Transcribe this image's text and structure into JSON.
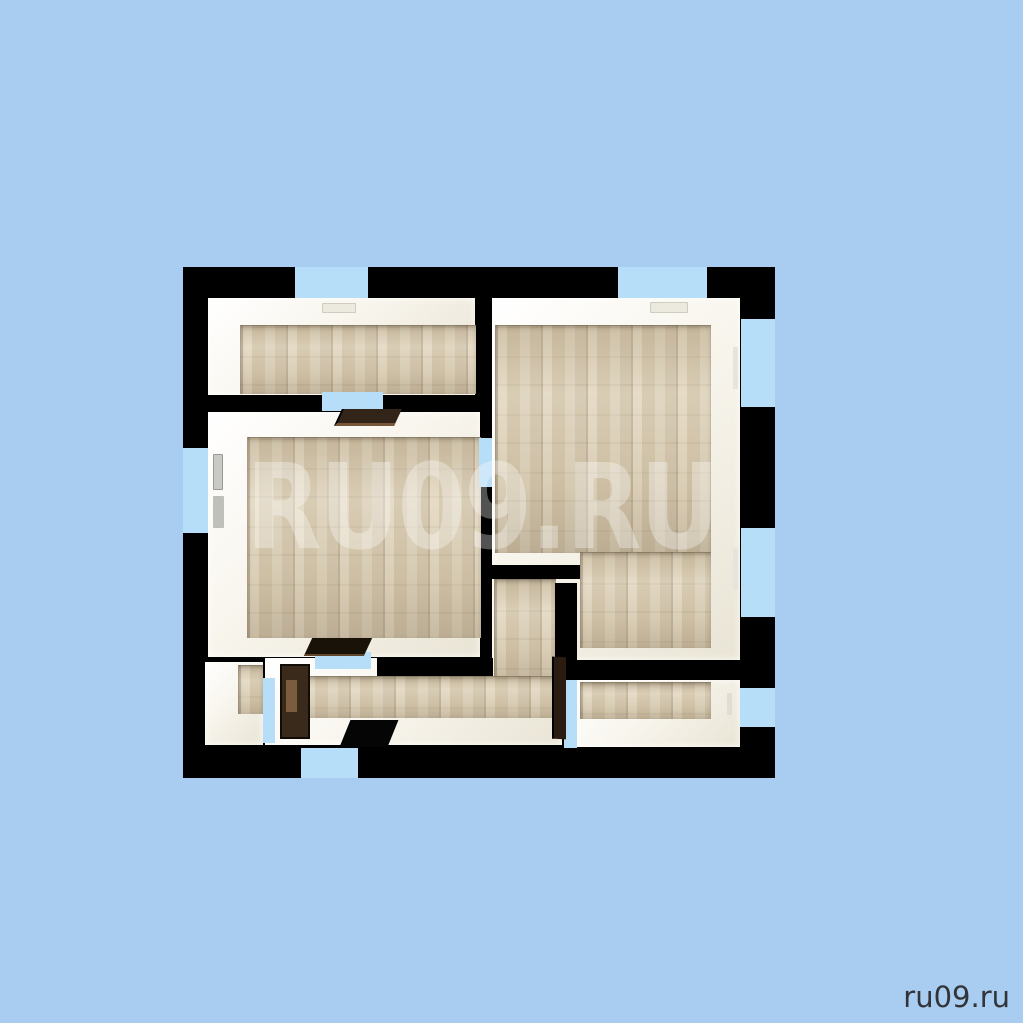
{
  "watermark": {
    "text": "RU09.RU"
  },
  "footer": {
    "site_label": "ru09.ru"
  },
  "palette": {
    "background": "#a9cdf0",
    "wall_black": "#000000",
    "window_blue": "#b7def8",
    "floor_wood": "#dbd0b8",
    "room_white": "#f8f5ed",
    "door_brown": "#33241a"
  }
}
